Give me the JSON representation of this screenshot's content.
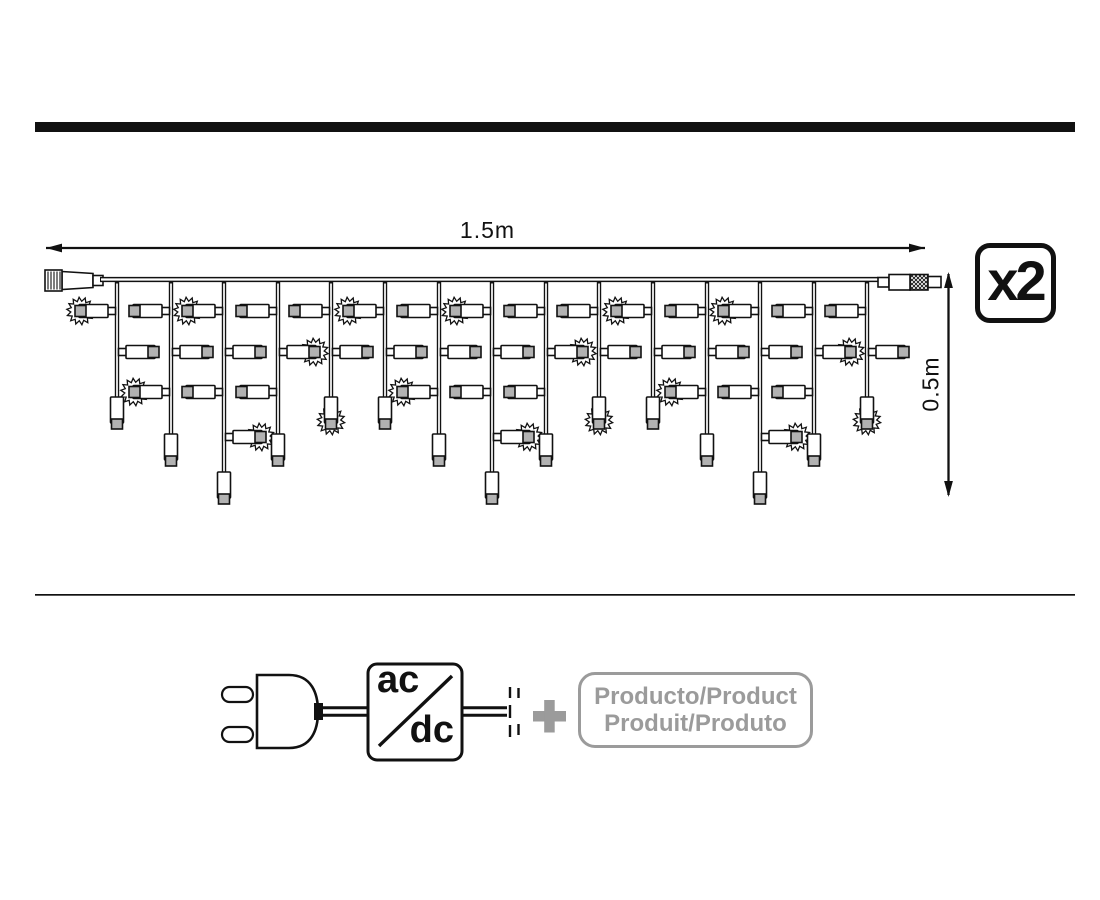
{
  "title": "icicle-lights-product-diagram",
  "colors": {
    "ink": "#111111",
    "gray": "#9b9b9b",
    "bulb_cap": "#b2b2b2",
    "background": "#ffffff"
  },
  "dimensions": {
    "length_label": "1.5m",
    "height_label": "0.5m"
  },
  "badge": {
    "label": "x2"
  },
  "converter": {
    "top_label": "ac",
    "bottom_label": "dc"
  },
  "plus_label": "+",
  "product_box": {
    "line1": "Producto/Product",
    "line2": "Produit/Produto"
  },
  "icons": [
    "power-plug-icon",
    "ac-dc-converter-icon",
    "plus-icon",
    "icicle-light-string",
    "flash-starburst-icon",
    "male-connector-icon",
    "female-connector-icon"
  ],
  "light_string": {
    "wire": {
      "x1": 100,
      "x2": 878,
      "y": 279.5
    },
    "rows": {
      "A": 311,
      "B": 352,
      "C": 392,
      "C2": 437
    },
    "len_body_top": {
      "m": 397,
      "l": 434,
      "xl": 472
    },
    "drops": [
      {
        "x": 117,
        "len": "m",
        "bottom_flash": false,
        "bulbs": [
          {
            "row": "A",
            "side": "left",
            "flash": true
          },
          {
            "row": "B",
            "side": "right",
            "flash": false
          }
        ]
      },
      {
        "x": 171,
        "len": "l",
        "bottom_flash": false,
        "bulbs": [
          {
            "row": "A",
            "side": "left",
            "flash": false
          },
          {
            "row": "B",
            "side": "right",
            "flash": false
          },
          {
            "row": "C",
            "side": "left",
            "flash": true
          }
        ]
      },
      {
        "x": 224,
        "len": "xl",
        "bottom_flash": false,
        "bulbs": [
          {
            "row": "A",
            "side": "left",
            "flash": true
          },
          {
            "row": "B",
            "side": "right",
            "flash": false
          },
          {
            "row": "C",
            "side": "left",
            "flash": false
          },
          {
            "row": "C2",
            "side": "right",
            "flash": true
          }
        ]
      },
      {
        "x": 278,
        "len": "l",
        "bottom_flash": false,
        "bulbs": [
          {
            "row": "A",
            "side": "left",
            "flash": false
          },
          {
            "row": "B",
            "side": "right",
            "flash": true
          },
          {
            "row": "C",
            "side": "left",
            "flash": false
          }
        ]
      },
      {
        "x": 331,
        "len": "m",
        "bottom_flash": true,
        "bulbs": [
          {
            "row": "A",
            "side": "left",
            "flash": false
          },
          {
            "row": "B",
            "side": "right",
            "flash": false
          }
        ]
      },
      {
        "x": 385,
        "len": "m",
        "bottom_flash": false,
        "bulbs": [
          {
            "row": "A",
            "side": "left",
            "flash": true
          },
          {
            "row": "B",
            "side": "right",
            "flash": false
          }
        ]
      },
      {
        "x": 439,
        "len": "l",
        "bottom_flash": false,
        "bulbs": [
          {
            "row": "A",
            "side": "left",
            "flash": false
          },
          {
            "row": "B",
            "side": "right",
            "flash": false
          },
          {
            "row": "C",
            "side": "left",
            "flash": true
          }
        ]
      },
      {
        "x": 492,
        "len": "xl",
        "bottom_flash": false,
        "bulbs": [
          {
            "row": "A",
            "side": "left",
            "flash": true
          },
          {
            "row": "B",
            "side": "right",
            "flash": false
          },
          {
            "row": "C",
            "side": "left",
            "flash": false
          },
          {
            "row": "C2",
            "side": "right",
            "flash": true
          }
        ]
      },
      {
        "x": 546,
        "len": "l",
        "bottom_flash": false,
        "bulbs": [
          {
            "row": "A",
            "side": "left",
            "flash": false
          },
          {
            "row": "B",
            "side": "right",
            "flash": true
          },
          {
            "row": "C",
            "side": "left",
            "flash": false
          }
        ]
      },
      {
        "x": 599,
        "len": "m",
        "bottom_flash": true,
        "bulbs": [
          {
            "row": "A",
            "side": "left",
            "flash": false
          },
          {
            "row": "B",
            "side": "right",
            "flash": false
          }
        ]
      },
      {
        "x": 653,
        "len": "m",
        "bottom_flash": false,
        "bulbs": [
          {
            "row": "A",
            "side": "left",
            "flash": true
          },
          {
            "row": "B",
            "side": "right",
            "flash": false
          }
        ]
      },
      {
        "x": 707,
        "len": "l",
        "bottom_flash": false,
        "bulbs": [
          {
            "row": "A",
            "side": "left",
            "flash": false
          },
          {
            "row": "B",
            "side": "right",
            "flash": false
          },
          {
            "row": "C",
            "side": "left",
            "flash": true
          }
        ]
      },
      {
        "x": 760,
        "len": "xl",
        "bottom_flash": false,
        "bulbs": [
          {
            "row": "A",
            "side": "left",
            "flash": true
          },
          {
            "row": "B",
            "side": "right",
            "flash": false
          },
          {
            "row": "C",
            "side": "left",
            "flash": false
          },
          {
            "row": "C2",
            "side": "right",
            "flash": true
          }
        ]
      },
      {
        "x": 814,
        "len": "l",
        "bottom_flash": false,
        "bulbs": [
          {
            "row": "A",
            "side": "left",
            "flash": false
          },
          {
            "row": "B",
            "side": "right",
            "flash": true
          },
          {
            "row": "C",
            "side": "left",
            "flash": false
          }
        ]
      },
      {
        "x": 867,
        "len": "m",
        "bottom_flash": true,
        "bulbs": [
          {
            "row": "A",
            "side": "left",
            "flash": false
          },
          {
            "row": "B",
            "side": "right",
            "flash": false
          }
        ]
      }
    ]
  }
}
